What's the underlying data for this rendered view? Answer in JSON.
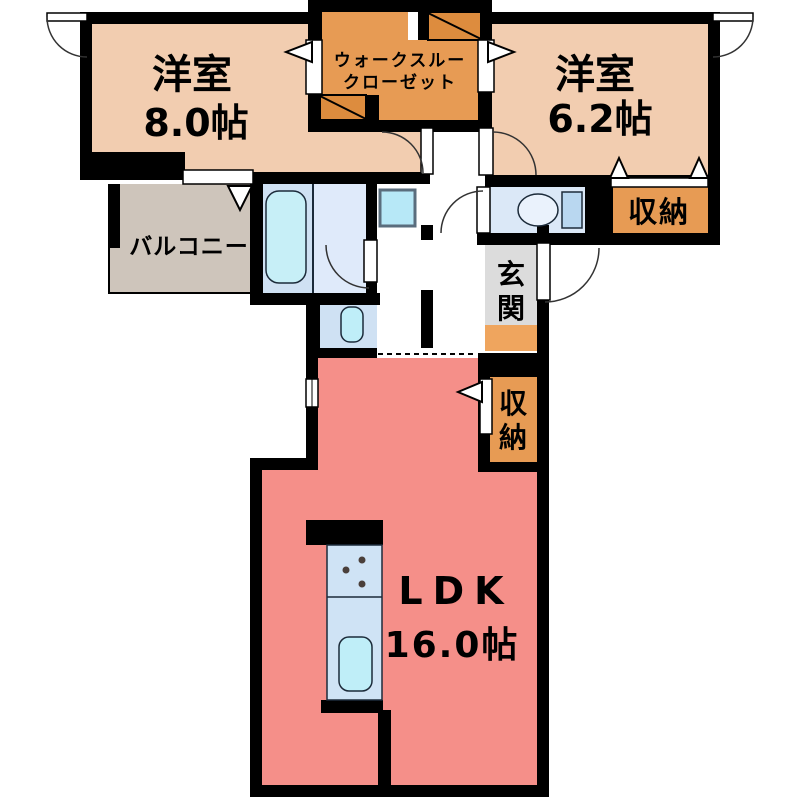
{
  "plan": {
    "bedroom_main": {
      "name": "洋室",
      "area": "8.0帖"
    },
    "walk_through_closet": {
      "name_line1": "ウォークスルー",
      "name_line2": "クローゼット"
    },
    "bedroom_second": {
      "name": "洋室",
      "area": "6.2帖"
    },
    "storage_upper": {
      "name": "収納"
    },
    "balcony": {
      "name": "バルコニー"
    },
    "entrance": {
      "name": "玄関",
      "char1": "玄",
      "char2": "関"
    },
    "storage_hall": {
      "name": "収納",
      "char1": "収",
      "char2": "納"
    },
    "ldk": {
      "name": "LDK",
      "area": "16.0帖"
    }
  },
  "colors": {
    "wall": "#000000",
    "bedroom_fill": "#f2cdb0",
    "closet_fill": "#e79b54",
    "closet_box_fill": "#dd8c3e",
    "storage_fill": "#e79b54",
    "ldk_fill": "#f58f89",
    "balcony_fill": "#cec5bb",
    "entrance_fill": "#dcdcdc",
    "entrance_step_fill": "#efa55e",
    "bath_fill": "#cfe1f3",
    "washroom_fill": "#dfeafa",
    "washbasin_fill": "#cfe1f3",
    "toilet_room_fill": "#dbe8f7",
    "tub_fill": "#c7eff7",
    "fixture_fill": "#bfeef8",
    "counter_fill": "#cfe3f5",
    "tank_fill": "#b9d7f0",
    "washer_fill": "#b7e8f7"
  }
}
